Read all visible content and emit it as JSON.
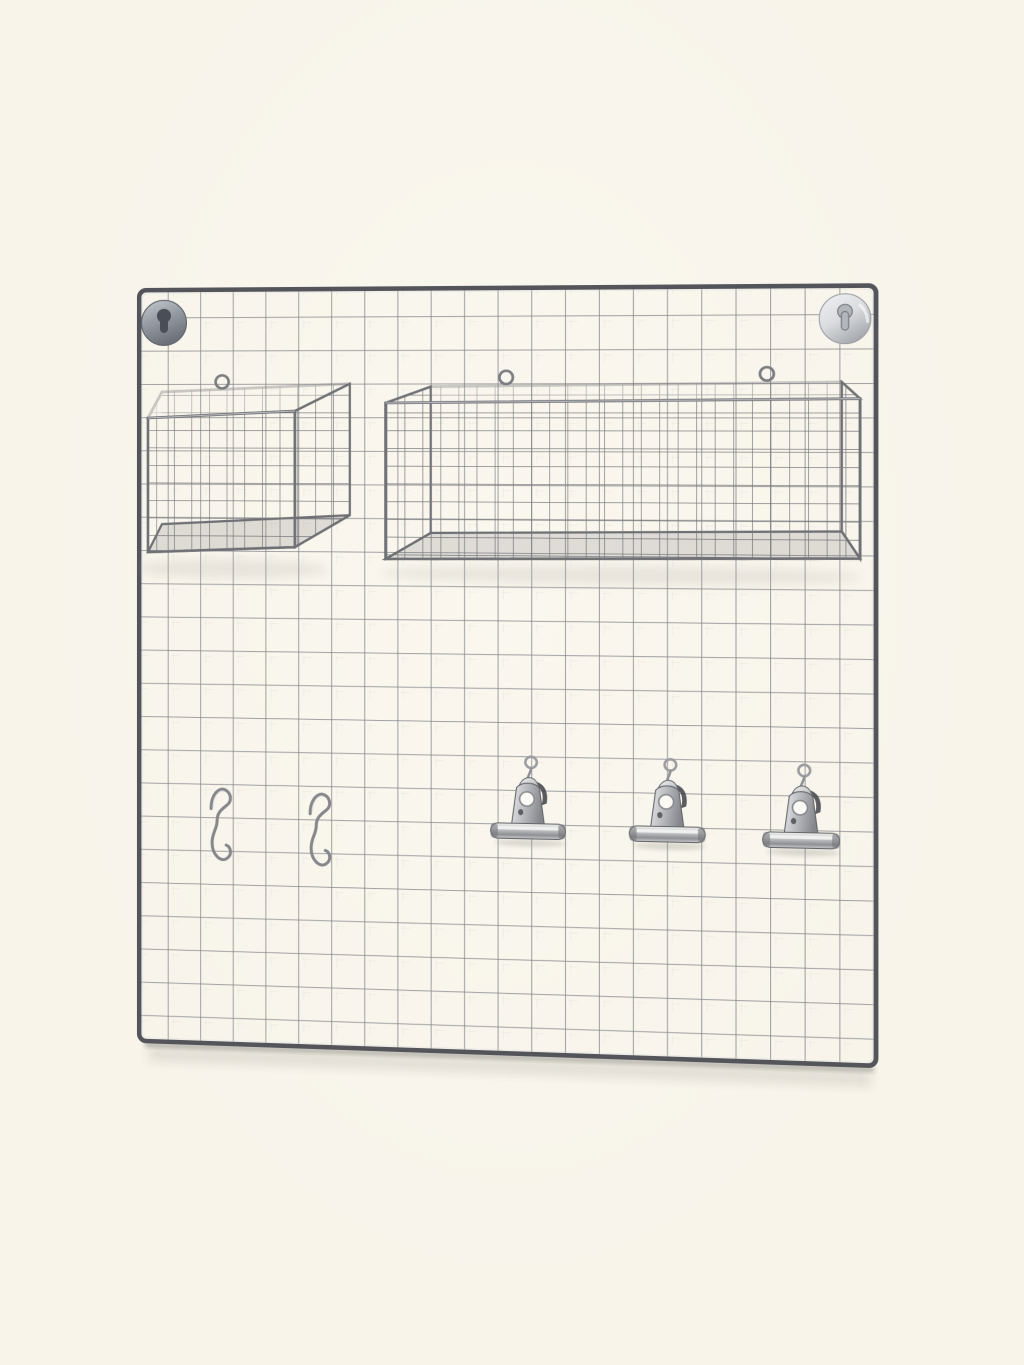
{
  "meta": {
    "type": "product-photo",
    "description": "Silver metal wire grid wall organizer panel on a cream background, fitted with two keyhole wall mounts, a small cube wire basket, a long rectangular wire basket, two S-hooks and three metal bulldog clips",
    "background_color": "#f8f4ea"
  },
  "palette": {
    "bg": "#f8f4ea",
    "frame": "#53555b",
    "wire": "#84858a",
    "wire-highlight": "#dcdcd6",
    "basket-wire": "#75777b",
    "rim": "#6f7175",
    "steel-dark": "#4a4e57",
    "chrome-light": "#eff0f2",
    "shadow": "#8f8d85"
  },
  "board": {
    "label": "square wire grid memo panel",
    "columns": 22,
    "rows": 23
  },
  "items": {
    "keyhole_mounts": {
      "count": 2,
      "labels": [
        "keyhole wall mount top left",
        "keyhole wall mount top right"
      ]
    },
    "baskets": {
      "count": 2,
      "labels": [
        "small cube wire basket",
        "long rectangular wire basket"
      ]
    },
    "s_hooks": {
      "count": 2,
      "labels": [
        "metal S-hook left",
        "metal S-hook right"
      ]
    },
    "binder_clips": {
      "count": 3,
      "labels": [
        "bulldog clip left",
        "bulldog clip middle",
        "bulldog clip right"
      ]
    }
  }
}
